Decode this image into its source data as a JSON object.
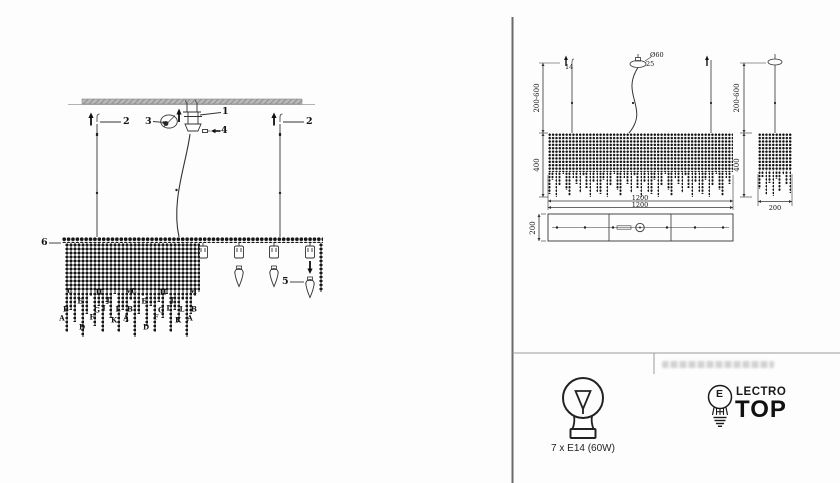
{
  "left_panel": {
    "callout_1": "1",
    "callout_2_left": "2",
    "callout_2_right": "2",
    "callout_3": "3",
    "callout_4": "4",
    "callout_5": "5",
    "callout_6": "6",
    "fringe_letters": [
      "C",
      "E",
      "B",
      "A",
      "D",
      "F",
      "G",
      "H",
      "I",
      "J",
      "K",
      "L",
      "M"
    ],
    "fringe_letters_end": [
      "B",
      "A"
    ]
  },
  "right_panel": {
    "front_view": {
      "suspension_range": "200-600",
      "body_height": "400",
      "hook_size": "14",
      "canopy_diameter": "Ø60",
      "canopy_height": "25",
      "width_dim_1": "1200",
      "width_dim_2": "1200"
    },
    "side_view": {
      "suspension_range": "200-600",
      "body_height": "400",
      "bottom_width": "200"
    },
    "plan_view": {
      "depth": "200"
    }
  },
  "spec": {
    "bulb_count_label": "7 x E14 (60W)"
  },
  "brand": {
    "bulb_letter": "E",
    "name_part1": "LECTRO",
    "name_part2": "TOP"
  },
  "colors": {
    "line": "#333333",
    "divider": "#6a6a6a",
    "beads": "#161616",
    "ceiling_bar": "#b0b0b0"
  }
}
